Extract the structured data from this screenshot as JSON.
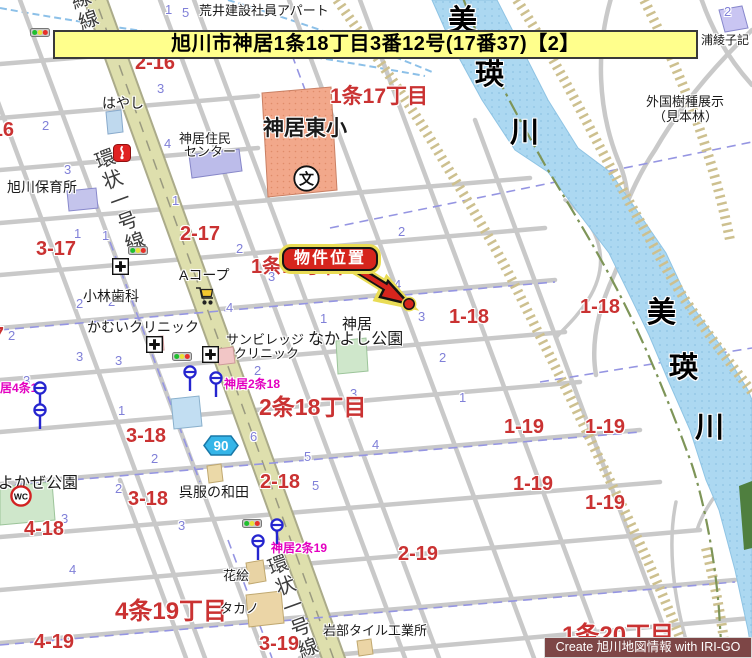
{
  "banner": {
    "text": "旭川市神居1条18丁目3番12号(17番37)【2】"
  },
  "callout": {
    "text": "物件位置"
  },
  "credit": {
    "text": "Create 旭川地図情報 with IRI-GO"
  },
  "colors": {
    "banner_bg": "#FFFF8C",
    "callout_red": "#D6251D",
    "callout_glow": "#E9DC55",
    "block_red": "#CA3232",
    "lot_blue": "#8080D8",
    "busstop_magenta": "#E300C0",
    "river_blue": "#ACD8F1",
    "ring_road": "#DEDFAD",
    "levee_khaki": "#CDC08F",
    "credit_bg": "#7D4646"
  },
  "labels": {
    "district_big": [
      {
        "text": "1条17丁目",
        "x": 330,
        "y": 86,
        "s": 21
      },
      {
        "text": "1条18丁目",
        "x": 251,
        "y": 257,
        "s": 20,
        "z": 4
      },
      {
        "text": "2条18丁目",
        "x": 259,
        "y": 395,
        "s": 23
      },
      {
        "text": "4条19丁目",
        "x": 115,
        "y": 599,
        "s": 24
      },
      {
        "text": "1条20丁目",
        "x": 562,
        "y": 623,
        "s": 24,
        "z": 7
      }
    ],
    "block_red": [
      {
        "text": "2-16",
        "x": 135,
        "y": 53
      },
      {
        "text": "3-16",
        "x": -26,
        "y": 120
      },
      {
        "text": "2-17",
        "x": 180,
        "y": 224
      },
      {
        "text": "3-17",
        "x": 36,
        "y": 239
      },
      {
        "text": "4-17",
        "x": -36,
        "y": 325
      },
      {
        "text": "1-18",
        "x": 449,
        "y": 307
      },
      {
        "text": "1-18",
        "x": 580,
        "y": 297
      },
      {
        "text": "3-18",
        "x": 126,
        "y": 426
      },
      {
        "text": "3-18",
        "x": 128,
        "y": 489
      },
      {
        "text": "2-18",
        "x": 260,
        "y": 472
      },
      {
        "text": "4-18",
        "x": 24,
        "y": 519
      },
      {
        "text": "1-19",
        "x": 504,
        "y": 417
      },
      {
        "text": "1-19",
        "x": 585,
        "y": 417
      },
      {
        "text": "1-19",
        "x": 513,
        "y": 474
      },
      {
        "text": "1-19",
        "x": 585,
        "y": 493
      },
      {
        "text": "2-19",
        "x": 398,
        "y": 544
      },
      {
        "text": "3-19",
        "x": 259,
        "y": 634
      },
      {
        "text": "4-19",
        "x": 34,
        "y": 632
      }
    ],
    "magenta": [
      {
        "text": "神居2条18",
        "x": 224,
        "y": 378
      },
      {
        "text": "神居2条19",
        "x": 271,
        "y": 542
      },
      {
        "text": "神居4条17",
        "x": -12,
        "y": 382
      }
    ],
    "facility": [
      {
        "text": "荒井建設社員アパート",
        "x": 199,
        "y": 4
      },
      {
        "text": "はやし",
        "x": 102,
        "y": 96,
        "s": 14
      },
      {
        "text": "神居住民",
        "x": 179,
        "y": 132
      },
      {
        "text": "センター",
        "x": 184,
        "y": 145
      },
      {
        "text": "神居東小",
        "x": 263,
        "y": 118,
        "s": 21,
        "fw": "bold"
      },
      {
        "text": "旭川保育所",
        "x": 7,
        "y": 180,
        "s": 14
      },
      {
        "text": "小林歯科",
        "x": 83,
        "y": 289,
        "s": 14
      },
      {
        "text": "Aコープ",
        "x": 179,
        "y": 268,
        "s": 14
      },
      {
        "text": "かむいクリニック",
        "x": 87,
        "y": 320,
        "s": 14
      },
      {
        "text": "サンビレッジ",
        "x": 226,
        "y": 333
      },
      {
        "text": "クリニック",
        "x": 234,
        "y": 347
      },
      {
        "text": "神居",
        "x": 342,
        "y": 317,
        "s": 15
      },
      {
        "text": "なかよし公園",
        "x": 308,
        "y": 332,
        "s": 16
      },
      {
        "text": "よかぜ公園",
        "x": -2,
        "y": 476,
        "s": 16
      },
      {
        "text": "呉服の和田",
        "x": 179,
        "y": 485,
        "s": 14
      },
      {
        "text": "花絵",
        "x": 223,
        "y": 569
      },
      {
        "text": "タカノ",
        "x": 220,
        "y": 602
      },
      {
        "text": "岩部タイル工業所",
        "x": 323,
        "y": 624
      },
      {
        "text": "浦綾子記",
        "x": 701,
        "y": 34,
        "s": 12
      },
      {
        "text": "外国樹種展示",
        "x": 646,
        "y": 95
      },
      {
        "text": "（見本林）",
        "x": 653,
        "y": 110
      }
    ],
    "river": [
      {
        "text": "美",
        "x": 448,
        "y": 6
      },
      {
        "text": "瑛",
        "x": 475,
        "y": 60
      },
      {
        "text": "川",
        "x": 510,
        "y": 118
      },
      {
        "text": "美",
        "x": 647,
        "y": 298
      },
      {
        "text": "瑛",
        "x": 669,
        "y": 353
      },
      {
        "text": "川",
        "x": 695,
        "y": 413
      }
    ],
    "road": [
      {
        "text": "線線",
        "x": 64,
        "y": -10
      },
      {
        "text": "環状一号線",
        "x": 88,
        "y": 150
      },
      {
        "text": "環状一号線線",
        "x": 261,
        "y": 556
      }
    ],
    "blue_numbers": [
      {
        "text": "1",
        "x": 120,
        "y": 33
      },
      {
        "text": "1",
        "x": 165,
        "y": 3
      },
      {
        "text": "5",
        "x": 182,
        "y": 6
      },
      {
        "text": "3",
        "x": 157,
        "y": 82
      },
      {
        "text": "2",
        "x": 42,
        "y": 119
      },
      {
        "text": "4",
        "x": 164,
        "y": 137
      },
      {
        "text": "3",
        "x": 64,
        "y": 163
      },
      {
        "text": "1",
        "x": 172,
        "y": 194
      },
      {
        "text": "1",
        "x": 74,
        "y": 227
      },
      {
        "text": "1",
        "x": 102,
        "y": 229
      },
      {
        "text": "2",
        "x": 236,
        "y": 242
      },
      {
        "text": "2",
        "x": 76,
        "y": 297
      },
      {
        "text": "2",
        "x": 108,
        "y": 295
      },
      {
        "text": "4",
        "x": 226,
        "y": 301
      },
      {
        "text": "3",
        "x": 268,
        "y": 270
      },
      {
        "text": "1",
        "x": 320,
        "y": 312
      },
      {
        "text": "3",
        "x": 418,
        "y": 310
      },
      {
        "text": "4",
        "x": 394,
        "y": 278
      },
      {
        "text": "2",
        "x": 439,
        "y": 351
      },
      {
        "text": "2",
        "x": 398,
        "y": 225
      },
      {
        "text": "2",
        "x": 8,
        "y": 329
      },
      {
        "text": "3",
        "x": 76,
        "y": 350
      },
      {
        "text": "3",
        "x": 115,
        "y": 354
      },
      {
        "text": "3",
        "x": 23,
        "y": 374
      },
      {
        "text": "1",
        "x": 118,
        "y": 404
      },
      {
        "text": "2",
        "x": 254,
        "y": 364
      },
      {
        "text": "3",
        "x": 350,
        "y": 387
      },
      {
        "text": "6",
        "x": 250,
        "y": 430
      },
      {
        "text": "5",
        "x": 304,
        "y": 450
      },
      {
        "text": "2",
        "x": 151,
        "y": 452
      },
      {
        "text": "2",
        "x": 115,
        "y": 482
      },
      {
        "text": "5",
        "x": 312,
        "y": 479
      },
      {
        "text": "3",
        "x": 61,
        "y": 512
      },
      {
        "text": "3",
        "x": 178,
        "y": 519
      },
      {
        "text": "4",
        "x": 69,
        "y": 563
      },
      {
        "text": "1",
        "x": 459,
        "y": 391
      },
      {
        "text": "2",
        "x": 724,
        "y": 5
      },
      {
        "text": "4",
        "x": 372,
        "y": 438
      }
    ]
  },
  "icons": [
    {
      "type": "traffic-light",
      "x": 30,
      "y": 24
    },
    {
      "type": "traffic-light",
      "x": 128,
      "y": 242
    },
    {
      "type": "traffic-light",
      "x": 172,
      "y": 348
    },
    {
      "type": "traffic-light",
      "x": 242,
      "y": 515
    },
    {
      "type": "bus-stop",
      "x": 33,
      "y": 381
    },
    {
      "type": "bus-stop",
      "x": 33,
      "y": 403
    },
    {
      "type": "bus-stop",
      "x": 183,
      "y": 365
    },
    {
      "type": "bus-stop",
      "x": 209,
      "y": 371
    },
    {
      "type": "bus-stop",
      "x": 270,
      "y": 518
    },
    {
      "type": "bus-stop",
      "x": 251,
      "y": 534
    },
    {
      "type": "hospital",
      "x": 112,
      "y": 258
    },
    {
      "type": "hospital",
      "x": 146,
      "y": 336
    },
    {
      "type": "hospital",
      "x": 202,
      "y": 346
    },
    {
      "type": "fire-station",
      "x": 113,
      "y": 144
    },
    {
      "type": "shopping-cart",
      "x": 194,
      "y": 285
    },
    {
      "type": "wc",
      "x": 10,
      "y": 485,
      "glyph": "WC"
    },
    {
      "type": "school",
      "x": 293,
      "y": 165,
      "glyph": "文"
    },
    {
      "type": "route-shield",
      "x": 203,
      "y": 435,
      "glyph": "90"
    }
  ]
}
